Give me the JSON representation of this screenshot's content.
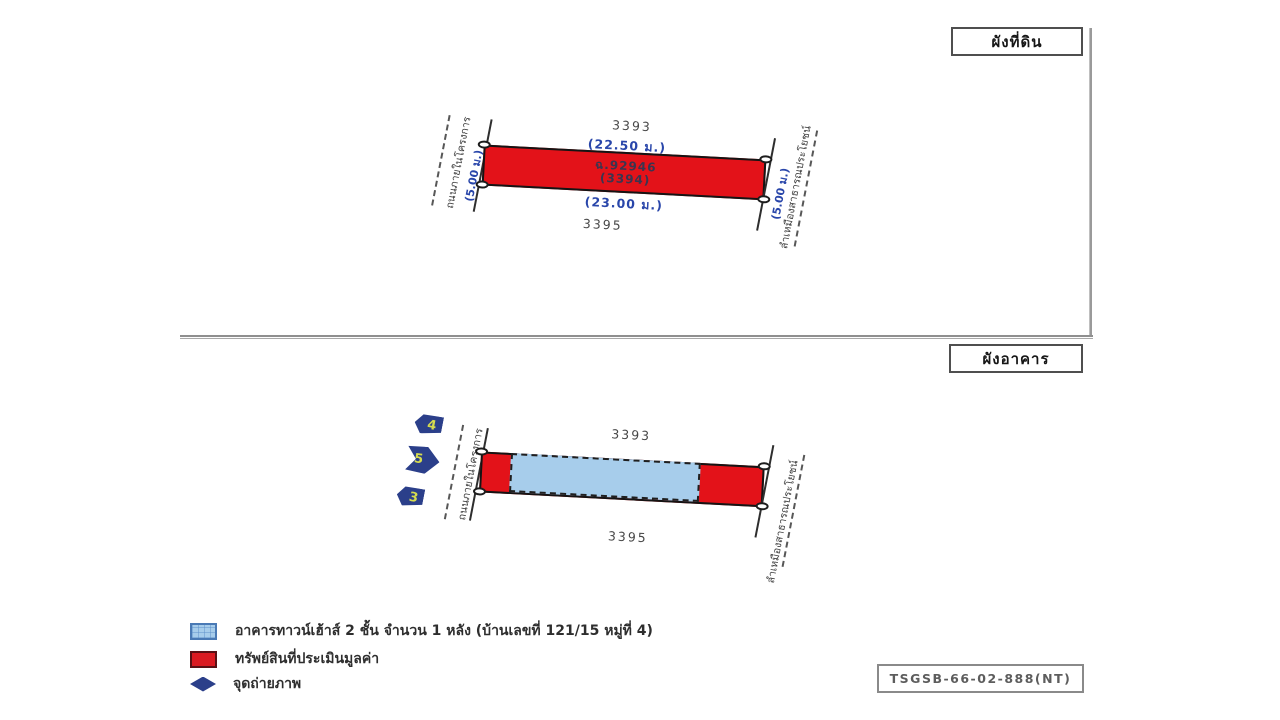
{
  "land_plan": {
    "title": "ผังที่ดิน",
    "north_parcel": "3393",
    "south_parcel": "3395",
    "top_width": "(22.50 ม.)",
    "bottom_width": "(23.00 ม.)",
    "left_depth": "(5.00 ม.)",
    "right_depth": "(5.00 ม.)",
    "deed_no": "ฉ.92946",
    "parcel_no": "(3394)",
    "left_boundary": "ถนนภายในโครงการ",
    "right_boundary": "ลำเหมืองสาธารณประโยชน์"
  },
  "building_plan": {
    "title": "ผังอาคาร",
    "north_parcel": "3393",
    "south_parcel": "3395",
    "left_boundary": "ถนนภายในโครงการ",
    "right_boundary": "ลำเหมืองสาธารณประโยชน์",
    "photo_points": [
      "4",
      "5",
      "3"
    ]
  },
  "legend": {
    "items": [
      {
        "icon": "townhouse-swatch",
        "label": "อาคารทาวน์เฮ้าส์ 2 ชั้น จำนวน 1 หลัง (บ้านเลขที่ 121/15 หมู่ที่ 4)"
      },
      {
        "icon": "appraised-property-swatch",
        "label": "ทรัพย์สินที่ประเมินมูลค่า"
      },
      {
        "icon": "photo-point-icon",
        "label": "จุดถ่ายภาพ"
      }
    ]
  },
  "reference": {
    "code": "TSGSB-66-02-888(NT)"
  },
  "colors": {
    "appraised_red": "#e31219",
    "building_blue": "#a7cdeb",
    "marker_navy": "#2b3f8a",
    "marker_number_yellow": "#d6dc4e",
    "dimension_blue": "#2946aa",
    "label_gray": "#474747"
  }
}
